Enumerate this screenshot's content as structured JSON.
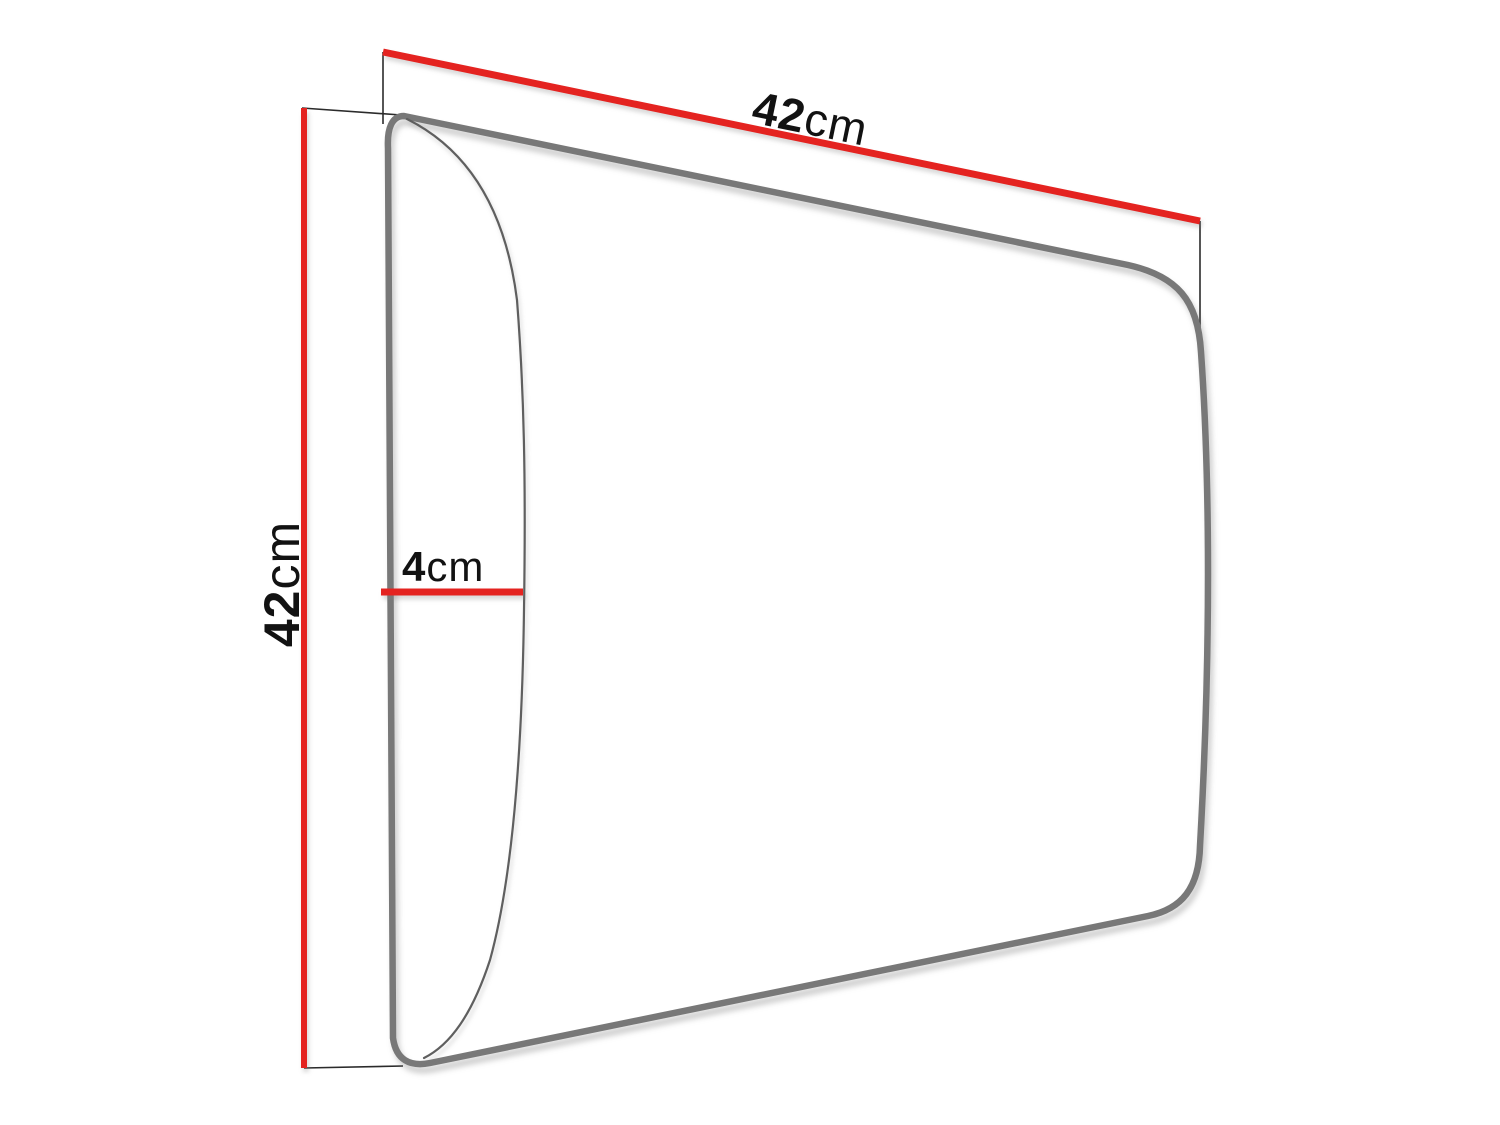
{
  "diagram": {
    "name": "panel-dimension-drawing",
    "description": "perspective outline drawing of an upholstered panel with dimension lines",
    "colors": {
      "background": "#ffffff",
      "dimension_line": "#e42320",
      "panel_outline": "#787878",
      "side_profile": "#5f5f5f",
      "extension_line": "#2b2b2b",
      "label_text": "#121212"
    },
    "labels": {
      "width": {
        "value": "42",
        "unit": "cm"
      },
      "height": {
        "value": "42",
        "unit": "cm"
      },
      "depth": {
        "value": "4",
        "unit": "cm"
      }
    }
  }
}
